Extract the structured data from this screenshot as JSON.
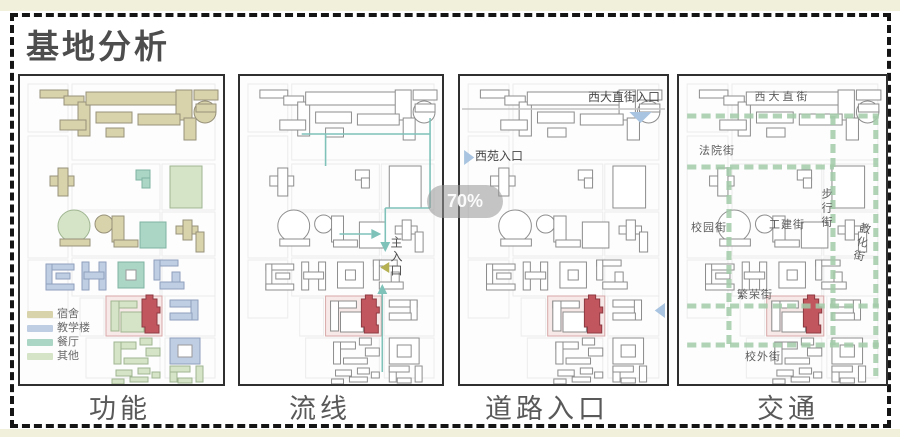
{
  "title": "基地分析",
  "zoom_badge": "70%",
  "panels": [
    {
      "id": "function",
      "label": "功能"
    },
    {
      "id": "circulation",
      "label": "流线",
      "main_entrance_label": "主入口"
    },
    {
      "id": "road-entrances",
      "label": "道路入口",
      "annotations": {
        "top_entrance": "西大直街入口",
        "left_entrance": "西苑入口"
      }
    },
    {
      "id": "traffic",
      "label": "交通",
      "streets": {
        "xidazhi": "西大直街",
        "fayuan": "法院街",
        "xiaoyuan": "校园街",
        "gongjian": "工建街",
        "buxing": "步行街",
        "jiaohua": "教化街",
        "fanrong": "繁荣街",
        "xiaowai": "校外街"
      }
    }
  ],
  "legend": [
    {
      "label": "宿舍",
      "color": "#d9d3ab"
    },
    {
      "label": "教学楼",
      "color": "#c0cee4"
    },
    {
      "label": "餐厅",
      "color": "#abd5c5"
    },
    {
      "label": "其他",
      "color": "#d5e4c7"
    }
  ],
  "colors": {
    "fill": {
      "dorm": "#d9d3ab",
      "teach": "#c0cee4",
      "dining": "#abd5c5",
      "other": "#d5e4c7",
      "red": "#c2565e",
      "site": "#f7e9e8",
      "hole": "#ffffff"
    },
    "stroke": {
      "dorm": "#97917a",
      "teach": "#8fa0bd",
      "dining": "#7fb3a4",
      "other": "#9fb591",
      "red": "#8f3a42",
      "site": "#d8a8a8",
      "hole": "#9a9a9a"
    },
    "outline_stroke": "#8d8d8d",
    "flow": "#7fc2ba",
    "street": "#a3cba9",
    "entrance_arrow": "#a9c4e0",
    "main_entrance_arrow": "#b5b052"
  },
  "map": {
    "parcels": [
      [
        52,
        8,
        143,
        76
      ],
      [
        8,
        8,
        40,
        48
      ],
      [
        8,
        60,
        40,
        122
      ],
      [
        8,
        184,
        40,
        58
      ],
      [
        52,
        88,
        88,
        46
      ],
      [
        142,
        88,
        53,
        46
      ],
      [
        52,
        136,
        88,
        44
      ],
      [
        142,
        136,
        53,
        44
      ],
      [
        52,
        182,
        88,
        38
      ],
      [
        142,
        182,
        53,
        38
      ],
      [
        60,
        222,
        24,
        38
      ],
      [
        145,
        220,
        50,
        40
      ],
      [
        66,
        262,
        74,
        40
      ],
      [
        145,
        262,
        50,
        40
      ]
    ],
    "buildings": [
      [
        "r",
        20,
        14,
        28,
        8,
        "dorm"
      ],
      [
        "r",
        44,
        20,
        20,
        9,
        "dorm"
      ],
      [
        "r",
        58,
        26,
        12,
        34,
        "dorm"
      ],
      [
        "r",
        40,
        44,
        26,
        10,
        "dorm"
      ],
      [
        "r",
        66,
        16,
        96,
        13,
        "dorm"
      ],
      [
        "r",
        156,
        14,
        16,
        30,
        "dorm"
      ],
      [
        "r",
        76,
        36,
        36,
        11,
        "dorm"
      ],
      [
        "r",
        118,
        38,
        42,
        11,
        "dorm"
      ],
      [
        "r",
        164,
        42,
        12,
        22,
        "dorm"
      ],
      [
        "r",
        86,
        52,
        18,
        9,
        "dorm"
      ],
      [
        "r",
        174,
        14,
        24,
        10,
        "dorm"
      ],
      [
        "c",
        185,
        36,
        11,
        "dorm"
      ],
      [
        "r",
        176,
        28,
        20,
        8,
        "dorm"
      ],
      [
        "r",
        30,
        100,
        24,
        10,
        "dorm"
      ],
      [
        "r",
        38,
        92,
        10,
        28,
        "dorm"
      ],
      [
        "r",
        116,
        94,
        14,
        10,
        "dining"
      ],
      [
        "r",
        122,
        102,
        8,
        10,
        "dining"
      ],
      [
        "r",
        150,
        90,
        32,
        42,
        "other"
      ],
      [
        "c",
        54,
        150,
        16,
        "other"
      ],
      [
        "r",
        40,
        163,
        30,
        7,
        "dorm"
      ],
      [
        "c",
        84,
        148,
        9,
        "dorm"
      ],
      [
        "r",
        92,
        140,
        12,
        26,
        "dorm"
      ],
      [
        "r",
        94,
        164,
        24,
        7,
        "dorm"
      ],
      [
        "r",
        120,
        146,
        26,
        26,
        "dining"
      ],
      [
        "r",
        156,
        150,
        22,
        8,
        "dorm"
      ],
      [
        "r",
        163,
        144,
        9,
        20,
        "dorm"
      ],
      [
        "r",
        176,
        156,
        8,
        20,
        "dorm"
      ],
      [
        "r",
        26,
        188,
        28,
        6,
        "teach"
      ],
      [
        "r",
        26,
        188,
        6,
        26,
        "teach"
      ],
      [
        "r",
        26,
        208,
        28,
        6,
        "teach"
      ],
      [
        "r",
        36,
        197,
        14,
        6,
        "teach"
      ],
      [
        "r",
        62,
        186,
        7,
        28,
        "teach"
      ],
      [
        "r",
        79,
        186,
        7,
        28,
        "teach"
      ],
      [
        "r",
        64,
        196,
        20,
        7,
        "teach"
      ],
      [
        "r",
        98,
        186,
        26,
        26,
        "dining"
      ],
      [
        "r",
        106,
        194,
        10,
        10,
        "hole"
      ],
      [
        "r",
        134,
        184,
        24,
        6,
        "teach"
      ],
      [
        "r",
        134,
        184,
        6,
        20,
        "teach"
      ],
      [
        "r",
        152,
        196,
        8,
        10,
        "teach"
      ],
      [
        "r",
        140,
        206,
        24,
        7,
        "teach"
      ],
      [
        "r",
        86,
        220,
        56,
        40,
        "site"
      ],
      [
        "r",
        91,
        225,
        26,
        7,
        "other"
      ],
      [
        "r",
        91,
        225,
        8,
        30,
        "other"
      ],
      [
        "r",
        101,
        236,
        23,
        20,
        "other"
      ],
      [
        "p",
        "122,228 122,223 126,223 126,219 133,219 133,223 137,223 137,231 140,231 140,237 137,237 137,249 139,249 139,257 125,257 125,251 122,251",
        "red"
      ],
      [
        "r",
        150,
        224,
        28,
        7,
        "teach"
      ],
      [
        "r",
        171,
        224,
        7,
        20,
        "teach"
      ],
      [
        "r",
        150,
        237,
        22,
        7,
        "teach"
      ],
      [
        "r",
        150,
        262,
        30,
        26,
        "teach"
      ],
      [
        "r",
        158,
        269,
        14,
        12,
        "hole"
      ],
      [
        "r",
        94,
        266,
        22,
        7,
        "other"
      ],
      [
        "r",
        94,
        266,
        7,
        22,
        "other"
      ],
      [
        "r",
        120,
        262,
        12,
        7,
        "other"
      ],
      [
        "r",
        126,
        272,
        14,
        8,
        "other"
      ],
      [
        "r",
        104,
        282,
        24,
        6,
        "other"
      ],
      [
        "r",
        96,
        294,
        16,
        6,
        "other"
      ],
      [
        "r",
        118,
        292,
        12,
        6,
        "other"
      ],
      [
        "r",
        92,
        303,
        12,
        5,
        "other"
      ],
      [
        "r",
        110,
        301,
        18,
        5,
        "other"
      ],
      [
        "r",
        132,
        296,
        8,
        6,
        "other"
      ],
      [
        "r",
        150,
        290,
        7,
        16,
        "other"
      ],
      [
        "r",
        150,
        290,
        20,
        6,
        "other"
      ],
      [
        "r",
        176,
        290,
        7,
        16,
        "other"
      ],
      [
        "r",
        158,
        302,
        14,
        5,
        "other"
      ]
    ],
    "flow": {
      "lines": [
        [
          191,
          42,
          191,
          132
        ],
        [
          62,
          58,
          191,
          58
        ],
        [
          146,
          132,
          191,
          132
        ],
        [
          146,
          132,
          146,
          168
        ],
        [
          100,
          158,
          132,
          158
        ],
        [
          143,
          216,
          143,
          296
        ],
        [
          86,
          58,
          86,
          90
        ]
      ],
      "arrows": [
        "141,166 151,166 146,176",
        "132,153 132,163 142,158",
        "138,218 148,218 143,208"
      ],
      "olive_arrow": "150,186 150,197 141,191.5"
    },
    "entrances": {
      "street_line": [
        2,
        33,
        201,
        33
      ],
      "triangles": [
        "166,36 188,36 177,47",
        "4,74 4,89 14,81.5",
        "201,227 201,242 191,234.5"
      ]
    },
    "streets": {
      "lines": [
        [
          8,
          40,
          196,
          40
        ],
        [
          8,
          91,
          152,
          91
        ],
        [
          8,
          230,
          196,
          230
        ],
        [
          8,
          269,
          196,
          269
        ],
        [
          49,
          91,
          49,
          269
        ],
        [
          151,
          40,
          151,
          269
        ],
        [
          193,
          40,
          193,
          300
        ]
      ]
    }
  }
}
